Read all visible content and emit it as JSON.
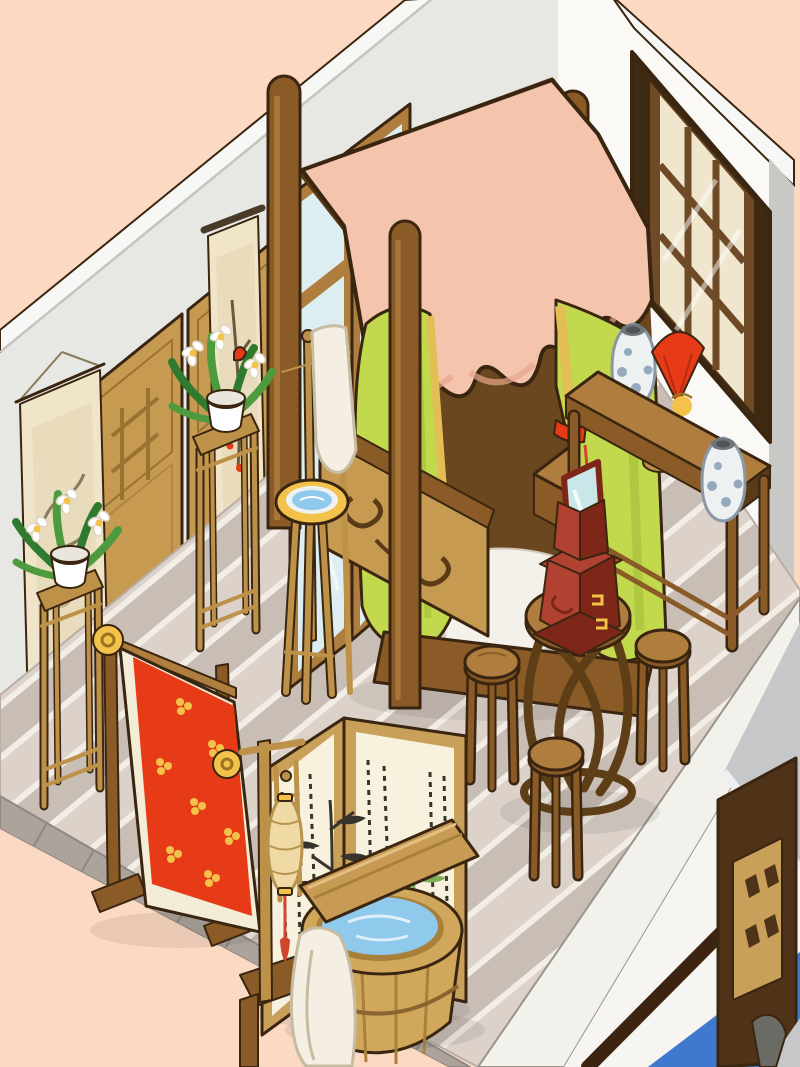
{
  "scene": {
    "type": "isometric-room-illustration",
    "theme": "traditional chinese bedroom",
    "view": "cutaway corner view on peach backdrop"
  },
  "palette": {
    "peach": "#FBD9C2",
    "wall_gray": "#E7E8E3",
    "wall_band": "#F7F8F5",
    "wall_edge": "#C8C9C5",
    "right_wall": "#FAF9F6",
    "outline": "#3A2510",
    "wood_dark": "#5B3A16",
    "wood_mid": "#8A5B26",
    "wood_light": "#AF7E3E",
    "wood_gold": "#BE9148",
    "panel_tan": "#C79A52",
    "panel_carve": "#9A7231",
    "floor_gap": "#F2EDE5",
    "floor_mid": "#DCD2CA",
    "floor_dark": "#C9BEB6",
    "edging_dark": "#8F8780",
    "edging_stone": "#ACA49C",
    "window_frame_dark": "#3E2912",
    "window_frame_mid": "#6F4A26",
    "window_pane": "#EFE6CD",
    "pane_line": "#C3B088",
    "scroll_paper": "#F1E5C9",
    "scroll_art": "#E8DCBC",
    "canopy_pink": "#F4C4AC",
    "pink_shade": "#E7A78C",
    "lattice_bg": "#F2D3BE",
    "curtain_green": "#C2D84D",
    "curtain_shade": "#A3BC3A",
    "curtain_yellow": "#E2BE55",
    "red": "#E73A17",
    "red_dark": "#8E1F0C",
    "gold": "#F2C24A",
    "gold_dark": "#9C7420",
    "porcelain_white": "#EDF1F2",
    "porcelain_blue": "#97A9BF",
    "porcelain_top": "#6E767C",
    "mirror_red": "#B14231",
    "mirror_red_dark": "#7E2718",
    "mirror_glass": "#C9E6E8",
    "screen_cream": "#F7F1DD",
    "ink": "#36342C",
    "bamboo_green": "#7FAE5C",
    "lantern_cream": "#EFD9A4",
    "tassel_red": "#D24531",
    "barrel_wood": "#D0A75B",
    "barrel_dark": "#A8803C",
    "water_blue": "#8FC9EC",
    "glass_blue": "#DCEEF1",
    "roof_gray": "#C5C7C9",
    "roof_edge": "#EEEFF0",
    "door_brown": "#4F3318",
    "lattice_tan": "#C9A05A",
    "ext_blue": "#3F78CF",
    "bedding": "#F4F1EA",
    "towel": "#F4EFE2",
    "leaf_green": "#4E9A3F",
    "leaf_dark": "#2F7A2E",
    "interior_dark": "#6B4720",
    "platform_edge": "#F2F1EC",
    "ext_white": "#F6F5F1"
  },
  "objects": {
    "room": "isometric room corner",
    "left_wall": "left wall",
    "right_wall": "right wall",
    "floor": "wood plank floor",
    "stone_edging": "stone floor edging",
    "window": "dark lattice window",
    "wall_panels": "carved wood wall panels",
    "scroll_large": "hanging scroll landscape painting",
    "scroll_small": "hanging scroll plum-blossom painting",
    "glass_screen": "glass room divider screen",
    "bed": "canopy bed with pink valance and green curtains",
    "pillow": "red pillow",
    "bedding": "white bedding",
    "footboard": "carved bed footboard",
    "step_stool": "bed step stool",
    "basin_stand": "washbasin stand with towel",
    "plant_stand_a": "tall plant stand with narcissus",
    "plant_stand_b": "tall plant stand with narcissus",
    "console_table": "altar table",
    "jar_1": "blue and white porcelain jar",
    "jar_2": "blue and white porcelain jar",
    "red_fan": "red fan",
    "gold_figurine": "golden figurine",
    "censer": "incense burner",
    "banner": "red banner with gold blossoms",
    "mirror_cabinet": "red dressing mirror cabinet",
    "round_table": "round tea table",
    "stool_1": "wooden stool",
    "stool_2": "wooden stool",
    "stool_3": "wooden stool",
    "folding_screen": "folding screen with bamboo ink painting",
    "lantern_stand": "standing lantern with red tassel",
    "bath_barrel": "wooden bath barrel",
    "bath_board": "wooden bath board",
    "bath_towel": "white towel",
    "exterior": "exterior roof and doorway",
    "door_panel": "lattice door panel",
    "blue_roof": "blue awning"
  }
}
